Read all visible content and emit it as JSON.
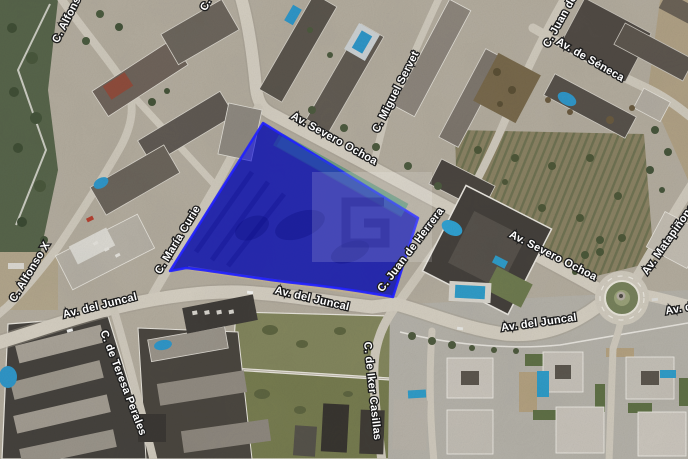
{
  "map": {
    "street_labels": [
      {
        "text": "C. Alfonso X"
      },
      {
        "text": "C."
      },
      {
        "text": "C. Miguel Servet"
      },
      {
        "text": "C. Juan de Herrera"
      },
      {
        "text": "Av. de Séneca"
      },
      {
        "text": "Av. Severo Ochoa"
      },
      {
        "text": "Av. Severo Ochoa"
      },
      {
        "text": "Av. Matapiñonera"
      },
      {
        "text": "C. María Curie"
      },
      {
        "text": "C. Juan de Herrera"
      },
      {
        "text": "C. Alfonso X"
      },
      {
        "text": "Av. del Juncal"
      },
      {
        "text": "Av. del Juncal"
      },
      {
        "text": "Av. del Juncal"
      },
      {
        "text": "Av. del Juncal"
      },
      {
        "text": "C. de Teresa Perales"
      },
      {
        "text": "C. de Iker Casillas"
      }
    ],
    "highlight": {
      "fill_color": "#2222dd",
      "stroke_color": "#2121ff",
      "opacity": 0.7
    },
    "watermark_glyph": "G"
  }
}
